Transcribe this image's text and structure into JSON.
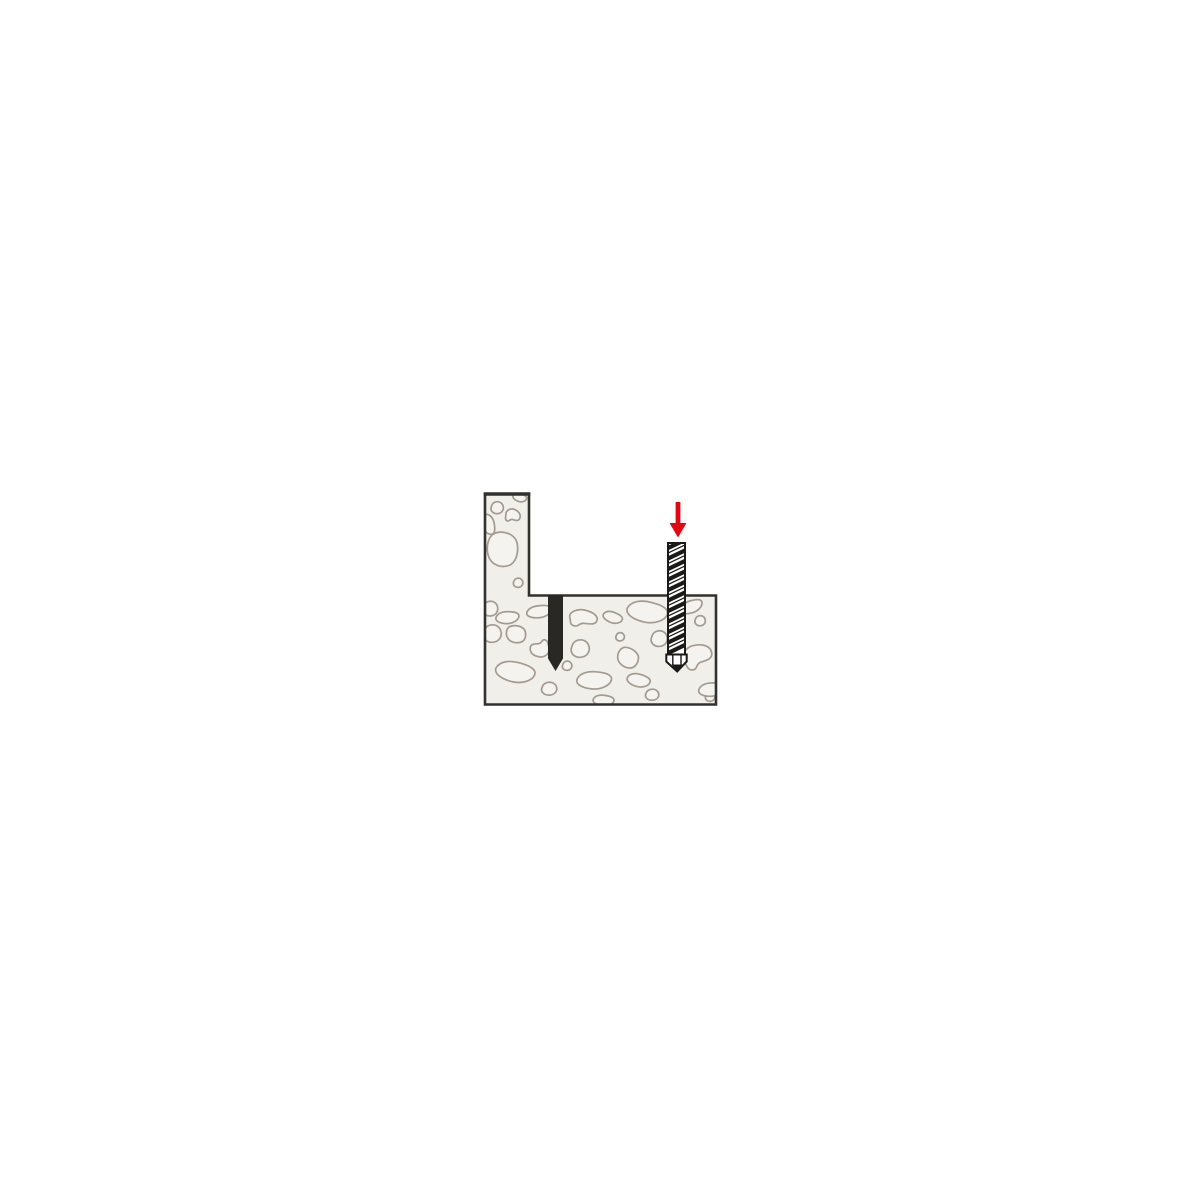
{
  "page": {
    "title": "Drilling instruction diagram"
  },
  "figure": {
    "name": "concrete-drilling-step-diagram",
    "description": "Cross-section of a stepped concrete member with one finished drilled hole and a masonry drill bit being driven downward into a second hole, indicated by a red down arrow.",
    "colors": {
      "page_background": "#ffffff",
      "concrete_fill": "#f1efea",
      "concrete_outline": "#33312d",
      "aggregate_stroke": "#a49a90",
      "aggregate_fill": "#f5f3ef",
      "drilled_hole_fill": "#2a2825",
      "drill_bit_fill": "#ffffff",
      "drill_bit_stroke": "#1b1a18",
      "arrow_color": "#e30613"
    },
    "elements": {
      "concrete_block": "stepped-concrete-cross-section",
      "aggregate": "aggregate-stones-texture",
      "drilled_hole": "finished-drill-hole",
      "drill_bit": "masonry-drill-bit",
      "direction_arrow": "down-arrow-icon"
    }
  }
}
